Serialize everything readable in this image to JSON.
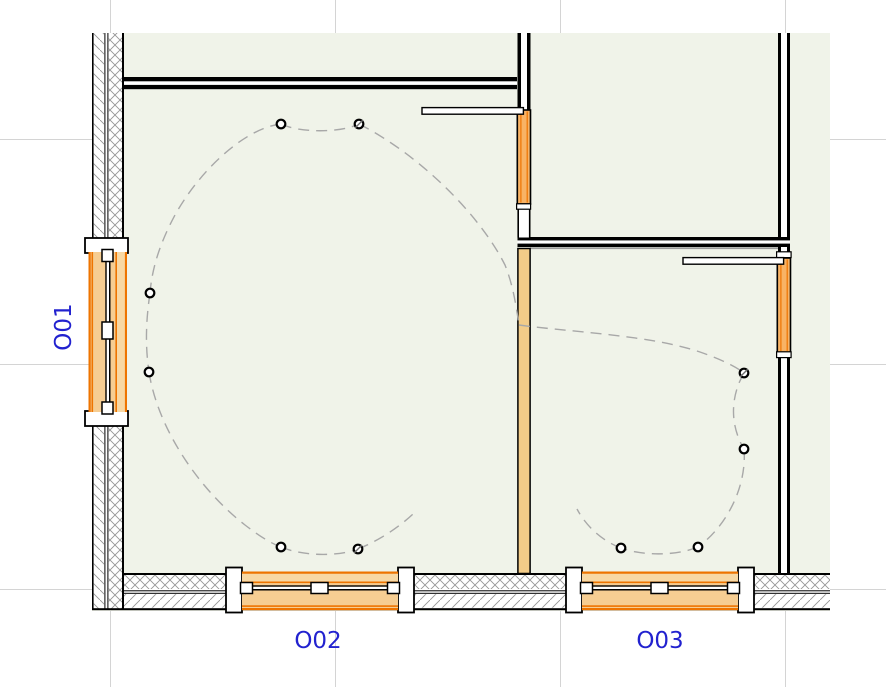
{
  "canvas": {
    "type": "2d-floor-plan-view",
    "background": "#ffffff",
    "floor_fill": "#f0f3e9"
  },
  "labels": {
    "o01": "O01",
    "o02": "O02",
    "o03": "O03"
  },
  "colors": {
    "window_fill": "#f6cd92",
    "window_fill_light": "#f8d8a4",
    "window_frame_orange": "#ee7400",
    "door_fill": "#f8b365",
    "interior_wall_fill": "#f3cc88",
    "label_blue": "#2222cf",
    "wall_black": "#000000",
    "grid_gray": "#d4d4d4",
    "wiring_path_gray": "#a8a8a8"
  },
  "elements": {
    "windows": [
      {
        "id": "O01",
        "wall": "west",
        "orientation": "vertical"
      },
      {
        "id": "O02",
        "wall": "south",
        "orientation": "horizontal"
      },
      {
        "id": "O03",
        "wall": "south",
        "orientation": "horizontal"
      }
    ],
    "sliding_doors_count": 2,
    "light_fixtures_count": 10,
    "grid_lines": {
      "vertical_count": 4,
      "horizontal_count": 3
    }
  }
}
